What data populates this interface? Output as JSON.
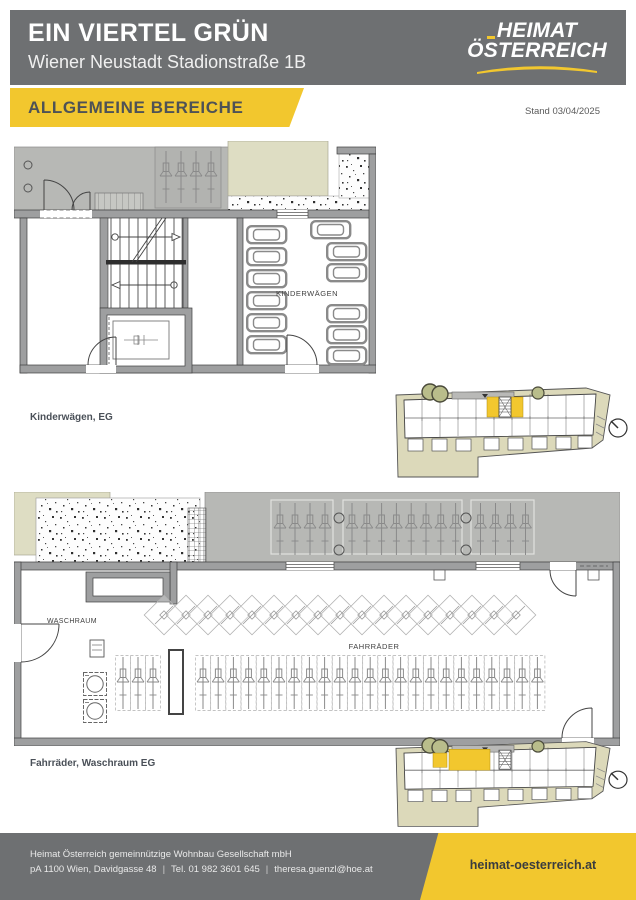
{
  "header": {
    "project_title": "EIN VIERTEL GRÜN",
    "project_subtitle": "Wiener Neustadt Stadionstraße 1B",
    "logo": {
      "line1": "HEIMAT",
      "line2": "ÖSTERREICH"
    },
    "section_title": "ALLGEMEINE BEREICHE",
    "stand_date": "Stand 03/04/2025"
  },
  "plans": [
    {
      "caption": "Kinderwägen, EG",
      "room_label": "KINDERWÄGEN"
    },
    {
      "caption": "Fahrräder, Waschraum EG",
      "room_label_laundry": "WASCHRAUM",
      "room_label_bikes": "FAHRRÄDER"
    }
  ],
  "footer": {
    "company": "Heimat Österreich gemeinnützige Wohnbau Gesellschaft mbH",
    "address": "pA 1100 Wien, Davidgasse 48",
    "phone": "Tel. 01 982 3601 645",
    "email": "theresa.guenzl@hoe.at",
    "website": "heimat-oesterreich.at"
  },
  "colors": {
    "brand_yellow": "#F2C72E",
    "header_gray": "#6E7072",
    "wall_gray": "#9E9FA0",
    "exterior_gray": "#B7B8B5",
    "plan_beige": "#DEDDC3",
    "site_beige": "#DCD9BA",
    "tree_green": "#B9BD8B",
    "text_dark": "#4A5058"
  }
}
